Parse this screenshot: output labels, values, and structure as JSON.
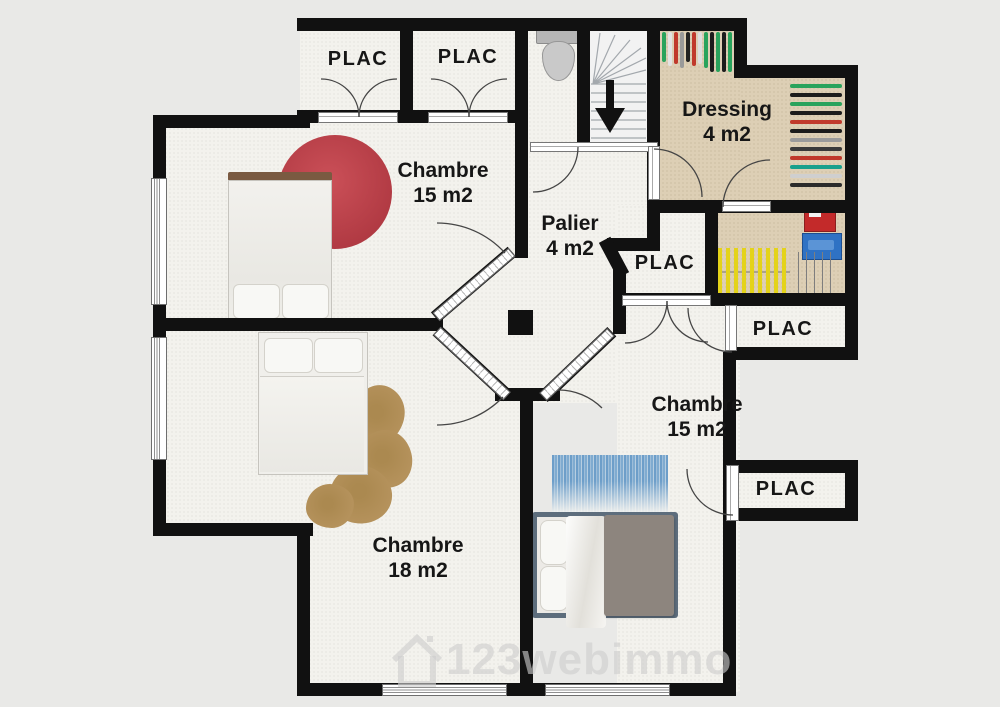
{
  "plan": {
    "watermark": "123webimmo",
    "rooms": {
      "plac_top_left": {
        "label": "PLAC"
      },
      "plac_top_right": {
        "label": "PLAC"
      },
      "chambre_top_left": {
        "name": "Chambre",
        "area": "15 m2"
      },
      "palier": {
        "name": "Palier",
        "area": "4 m2"
      },
      "dressing": {
        "name": "Dressing",
        "area": "4 m2"
      },
      "plac_middle": {
        "label": "PLAC"
      },
      "plac_right": {
        "label": "PLAC"
      },
      "chambre_right": {
        "name": "Chambre",
        "area": "15 m2"
      },
      "plac_bottom_right": {
        "label": "PLAC"
      },
      "chambre_bottom_left": {
        "name": "Chambre",
        "area": "18 m2"
      }
    },
    "colors": {
      "wall": "#111111",
      "floor": "#f3f2ed",
      "dressing_floor": "#ddcfb5",
      "outside": "#e9e9e7",
      "rug_red": "#b13a43",
      "rug_blue": "#6d9ec9",
      "rug_brown": "#b5925c",
      "bed_frame": "#5d6d7c",
      "blanket": "#8d857e"
    }
  }
}
